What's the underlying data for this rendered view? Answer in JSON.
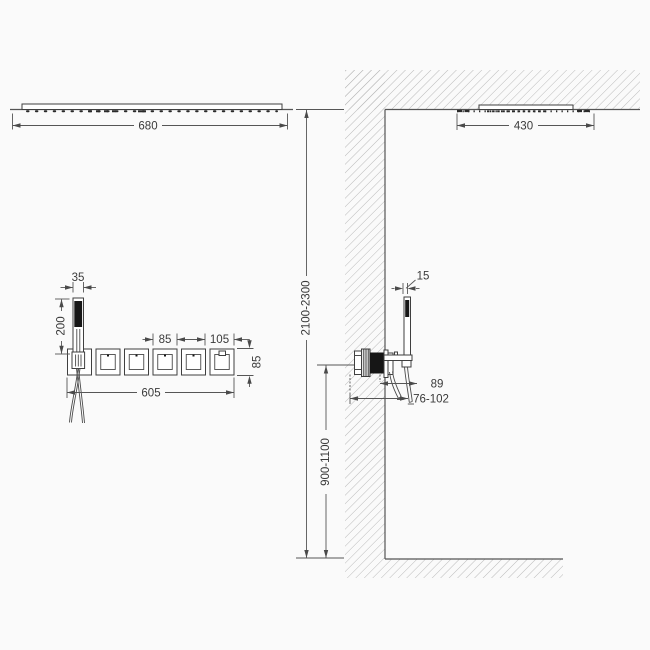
{
  "drawing": {
    "front_view": {
      "overhead_shower_width": "680",
      "handshower_width": "35",
      "handshower_length": "200",
      "module_width": "85",
      "end_section_width": "105",
      "panel_length": "605",
      "panel_height": "85"
    },
    "side_view": {
      "overhead_shower_depth": "430",
      "ceiling_height_range": "2100-2300",
      "valve_height_range": "900-1100",
      "handshower_diameter": "15",
      "projection": "89",
      "rough_in_depth_range": "76-102"
    },
    "style": {
      "line_color": "#555555",
      "fixture_color": "#3f3f3f",
      "hatch_color": "#b3b3b3",
      "text_color": "#3a3a3a",
      "background": "#fafafa"
    }
  }
}
